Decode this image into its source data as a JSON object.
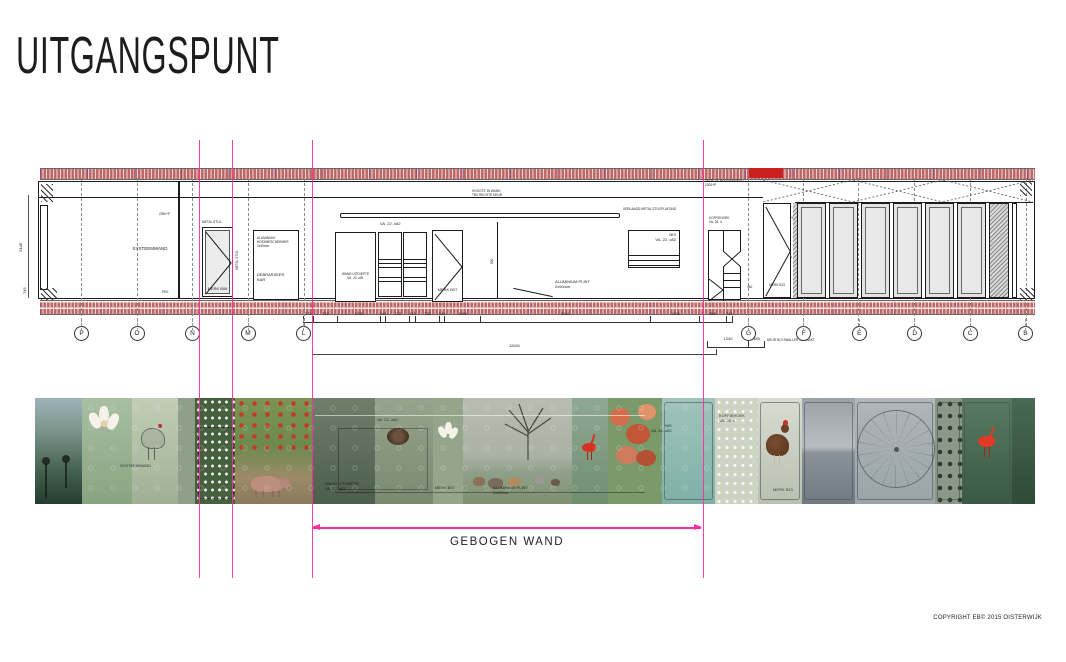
{
  "title": "UITGANGSPUNT",
  "copyright": "COPYRIGHT EB© 2015 OISTERWIJK",
  "gebogen_wand_label": "GEBOGEN WAND",
  "colors": {
    "magenta": "#ff2d9e",
    "brick_red": "#c06868",
    "drawing_line": "#1c1c1c",
    "glass_fill": "#e4e4e4",
    "red_accent": "#cc2020"
  },
  "drawing": {
    "grid_left": [
      "P",
      "O",
      "N",
      "M",
      "L"
    ],
    "grid_right": [
      "G",
      "F",
      "E",
      "D",
      "C",
      "B"
    ],
    "dim_row1": [
      271,
      752,
      1295,
      143,
      725,
      143,
      725,
      143,
      1080,
      5341,
      1506,
      809,
      142
    ],
    "dim_total": "12691",
    "dim_right_a": "1240",
    "dim_right_b": "485",
    "dim_right_note": "DEUR B13 SMALLER GEMAAKT",
    "labels": {
      "systeemwand": "SYSTEEMWAND",
      "bk_koz": "2350+P",
      "peil": "PEIL",
      "metal_stijl": "METAL STIJL",
      "merk_b06": "MERK B06",
      "hoekbeschermer": "ALUMINIUM\nHOEKBESCHERMER\n2x40mm",
      "debrasseer_kar": "DEBRASSEER\nKAR",
      "va22_o82": "VA. 22. o82",
      "wand_uitdiepte": "WAND UITDIEPTE\nVA. 22. o81",
      "merk_b07": "MERK B07",
      "dim_890": "890",
      "aluminium_plint": "ALUMINIUM PLINT\n2x50mm",
      "hoogte_in_wand": "HOOGTE IN WAND\nTBV RECHTE DEUR",
      "stucplafond": "VERLAAGD METAL STUCPLAFOND",
      "nis": "NIS\nVA. 22. o82",
      "plaf_niveau": "UM PLAF HOOGENIVEAU\n2300+P",
      "koffiehoek": "KOFFIEHOEK\nVA. 26. o",
      "dim_2250": "2250+P",
      "dim_950": "950+P",
      "dim_440": "440",
      "merk_b13": "MERK B13",
      "dim_2448": "2448",
      "dim_745": "745"
    }
  },
  "photo_strip": {
    "segments": [
      "misty-poppy-silhouettes",
      "white-magnolia",
      "chicken-sketch",
      "panel-transition",
      "daisy-hedge",
      "poppy-garden-with-pig",
      "dark-wall-panel",
      "birds-nest",
      "white-flower",
      "horses-under-bare-tree",
      "scarlet-ibis",
      "coral-flowers",
      "aqua-panel",
      "daisy-field",
      "brown-hen",
      "beach-horizon",
      "ferris-wheel",
      "dot-panel",
      "scarlet-ibis-on-green",
      "dark-green-end"
    ]
  }
}
